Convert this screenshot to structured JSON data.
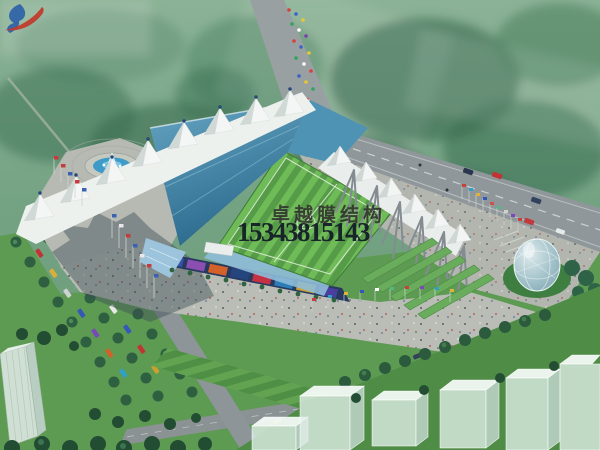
{
  "image_type": "aerial architectural rendering of a membrane-roof stadium",
  "watermark": {
    "logo_icon": "brush-swoosh-logo",
    "company": "卓越膜结构",
    "phone": "15343815143",
    "company_color": "rgba(40,38,36,0.82)",
    "phone_color": "#141d27",
    "logo_colors": {
      "blue": "#2b5fa8",
      "red": "#c0392b"
    }
  },
  "palette": {
    "forest_green": "#6f9e82",
    "lawn_green": "#5d9a52",
    "pitch_green_dark": "#569b48",
    "pitch_green_light": "#6fbb58",
    "roof_teal": "#3c7fa4",
    "membrane_white": "#eef2ef",
    "plaza_gray": "#b8bcb4",
    "road_gray": "#8f979a",
    "water_blue": "#3e9ac6",
    "seat_blue": "#8fbcd8",
    "dome_glass": "#9fbec6",
    "shadow": "#3f4e57"
  }
}
